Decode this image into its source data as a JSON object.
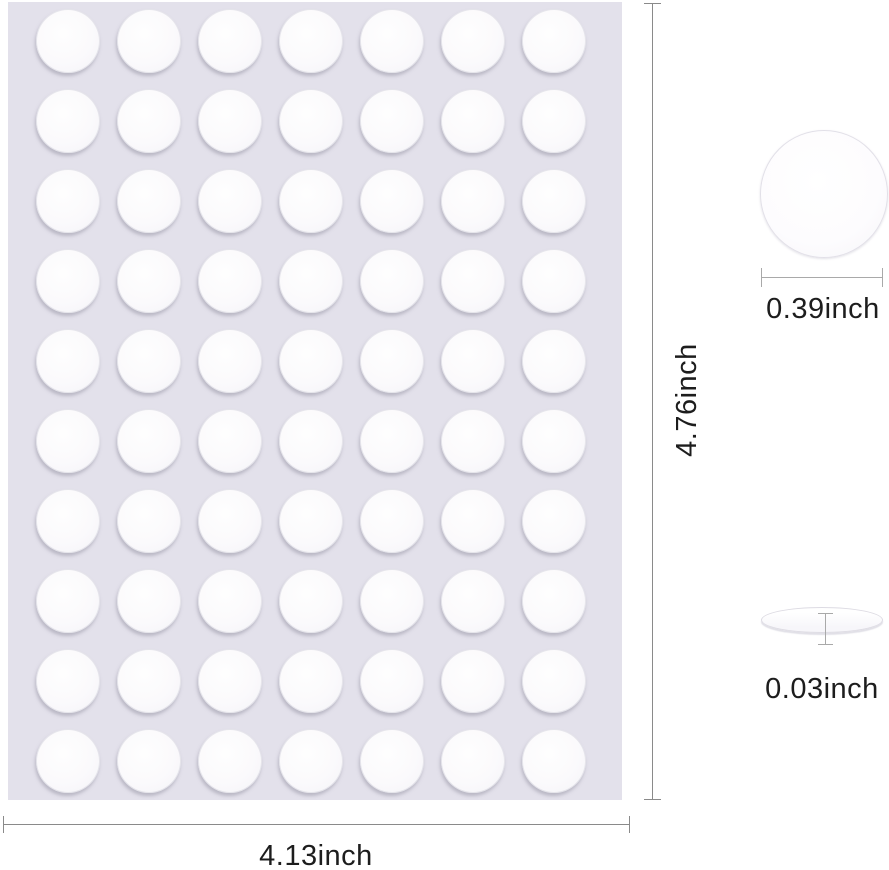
{
  "product_image": {
    "description": "adhesive-dot-sheet-dimension-diagram",
    "sheet": {
      "rows": 10,
      "cols": 7,
      "dot_count": 70,
      "sheet_color": "#e3e1eb",
      "dot_color": "#fcfbfd"
    },
    "dimensions": {
      "sheet_height_label": "4.76inch",
      "sheet_width_label": "4.13inch",
      "dot_diameter_label": "0.39inch",
      "dot_thickness_label": "0.03inch"
    },
    "colors": {
      "dimension_line": "#8a8a8a",
      "thickness_line": "#a9a9a9",
      "label_text": "#1d1d1d",
      "page_background": "#ffffff"
    }
  }
}
